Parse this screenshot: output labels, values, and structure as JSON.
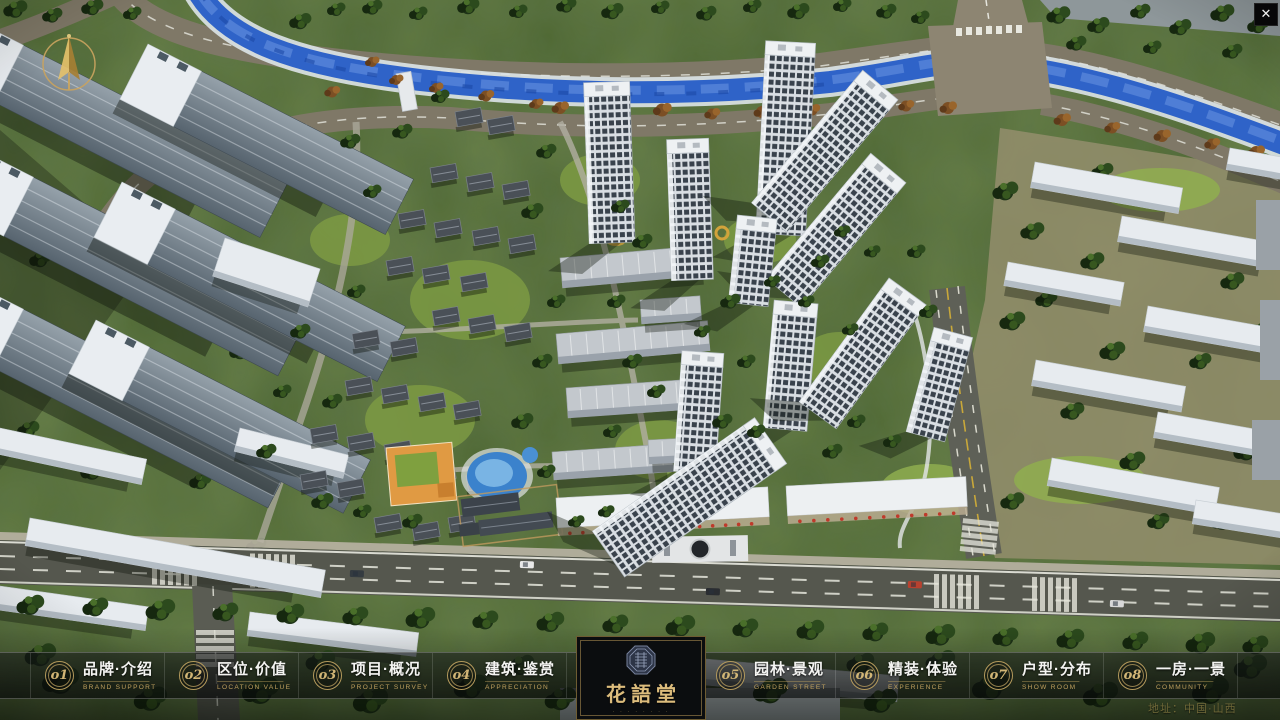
{
  "window": {
    "close_glyph": "✕"
  },
  "nav": {
    "items": [
      {
        "number": "o1",
        "zh": "品牌·介绍",
        "en": "BRAND SUPPORT"
      },
      {
        "number": "o2",
        "zh": "区位·价值",
        "en": "LOCATION VALUE"
      },
      {
        "number": "o3",
        "zh": "项目·概况",
        "en": "PROJECT SURVEY"
      },
      {
        "number": "o4",
        "zh": "建筑·鉴赏",
        "en": "APPRECIATION"
      },
      {
        "number": "o5",
        "zh": "园林·景观",
        "en": "GARDEN STREET"
      },
      {
        "number": "o6",
        "zh": "精装·体验",
        "en": "EXPERIENCE"
      },
      {
        "number": "o7",
        "zh": "户型·分布",
        "en": "SHOW ROOM"
      },
      {
        "number": "o8",
        "zh": "一房·一景",
        "en": "COMMUNITY"
      }
    ]
  },
  "logo": {
    "title": "花語堂",
    "subtitle": "· · · · · · · ·"
  },
  "footer": {
    "address": "地址：中国·山西"
  },
  "colors": {
    "accent_gold": "#c9a96a",
    "nav_bar_bg": "rgba(10,12,14,0.6)",
    "river_blue": "#2f63c8",
    "logo_bg": "#0b0d0f",
    "logo_border": "#6e5c32"
  }
}
